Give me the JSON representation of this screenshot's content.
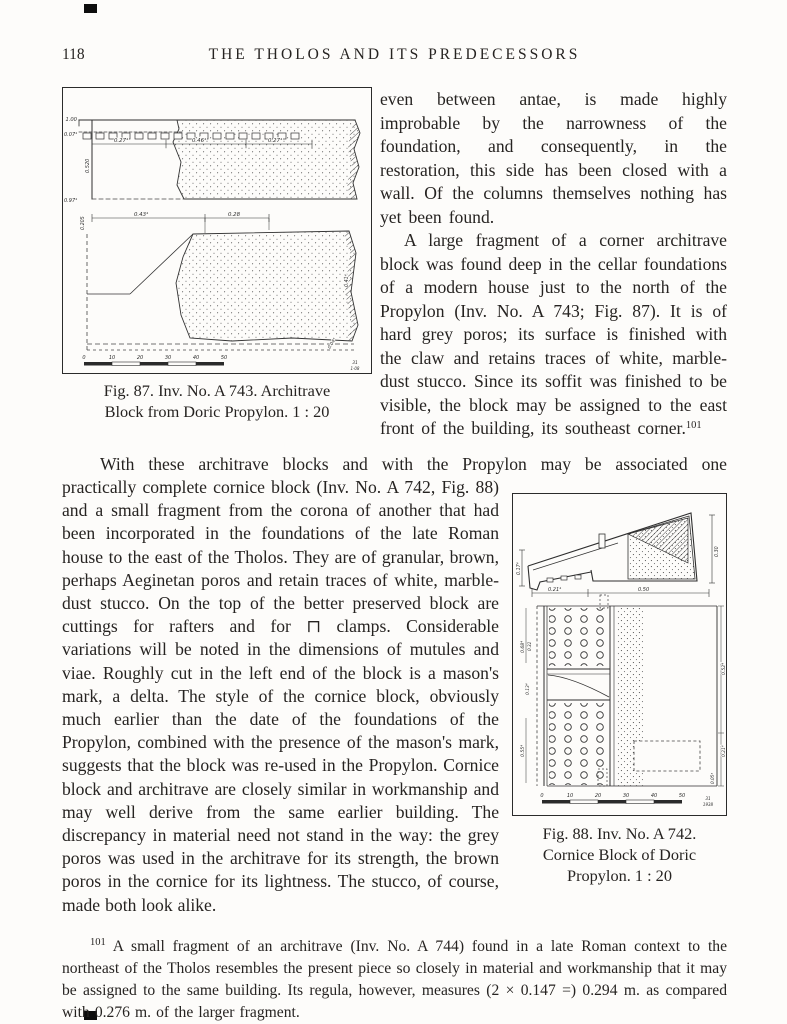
{
  "header": {
    "page_number": "118",
    "title": "THE THOLOS AND ITS PREDECESSORS"
  },
  "right_column": {
    "para1": "even between antae, is made highly improbable by the narrowness of the foundation, and consequently, in the restoration, this side has been closed with a wall. Of the columns themselves nothing has yet been found.",
    "para2": "A large fragment of a corner architrave block was found deep in the cellar foundations of a modern house just to the north of the Propylon (Inv. No. A 743; Fig. 87). It is of hard grey poros; its surface is finished with the claw and retains traces of white, marble-dust stucco. Since its soffit was finished to be visible, the block may be assigned to the east front of the building, its southeast corner.",
    "footnote_ref": "101"
  },
  "fig87": {
    "caption_line1": "Fig. 87. Inv. No. A 743. Architrave",
    "caption_line2": "Block from Doric Propylon. 1 : 20",
    "labels": {
      "top_left": "1.00",
      "taenia": "0.07⁴",
      "dim_left": "0.27⁴",
      "dim_mid": "0.46⁴",
      "dim_right": "0.27⁴",
      "height": "0.520",
      "bottom_left": "0.97⁴",
      "plan_offset": "0.205",
      "plan_dim_left": "0.43⁴",
      "plan_dim_right": "0.28",
      "plan_height": "0.41⁴",
      "plan_corner": "0.04⁴"
    },
    "scale": [
      "0",
      "10",
      "20",
      "30",
      "40",
      "50"
    ],
    "plate_mark_top": "31",
    "plate_mark_bottom": "1·08"
  },
  "body": {
    "lead_line": "With these architrave blocks and with the Propylon may be associated one",
    "continuation": "practically complete cornice block (Inv. No. A 742, Fig. 88) and a small fragment from the corona of another that had been incorporated in the foundations of the late Roman house to the east of the Tholos. They are of granular, brown, perhaps Aeginetan poros and retain traces of white, marble-dust stucco. On the top of the better preserved block are cuttings for rafters and for ⊓ clamps. Considerable variations will be noted in the dimensions of mutules and viae. Roughly cut in the left end of the block is a mason's mark, a delta. The style of the cornice block, obviously much earlier than the date of the foundations of the Propylon, combined with the presence of the mason's mark, suggests that the block was re-used in the Propylon. Cornice block and architrave are closely similar in workmanship and may well derive from the same earlier building. The discrepancy in material need not stand in the way: the grey poros was used in the architrave for its strength, the brown poros in the cornice for its lightness. The stucco, of course, made both look alike."
  },
  "fig88": {
    "caption_line1": "Fig. 88. Inv. No. A 742.",
    "caption_line2": "Cornice Block of Doric",
    "caption_line3": "Propylon. 1 : 20",
    "labels": {
      "section_left": "0.17⁴",
      "section_bottom_left": "0.21⁴",
      "section_bottom_right": "0.50",
      "section_right": "0.30",
      "plan_left_top": "0.68⁴",
      "plan_left_top2": "0.32",
      "plan_left_mid": "0.13⁴",
      "plan_left_bottom": "0.55⁴",
      "plan_right_top": "0.52⁴",
      "plan_right_bottom": "0.21⁴",
      "plan_right_corner": "0.05⁴"
    },
    "scale": [
      "0",
      "10",
      "20",
      "30",
      "40",
      "50"
    ],
    "plate_mark_top": "31",
    "plate_mark_bottom": "1938"
  },
  "footnote": {
    "marker": "101",
    "text": "A small fragment of an architrave (Inv. No. A 744) found in a late Roman context to the northeast of the Tholos resembles the present piece so closely in material and workmanship that it may be assigned to the same building. Its regula, however, measures (2 × 0.147 =) 0.294 m. as compared with 0.276 m. of the larger fragment."
  }
}
